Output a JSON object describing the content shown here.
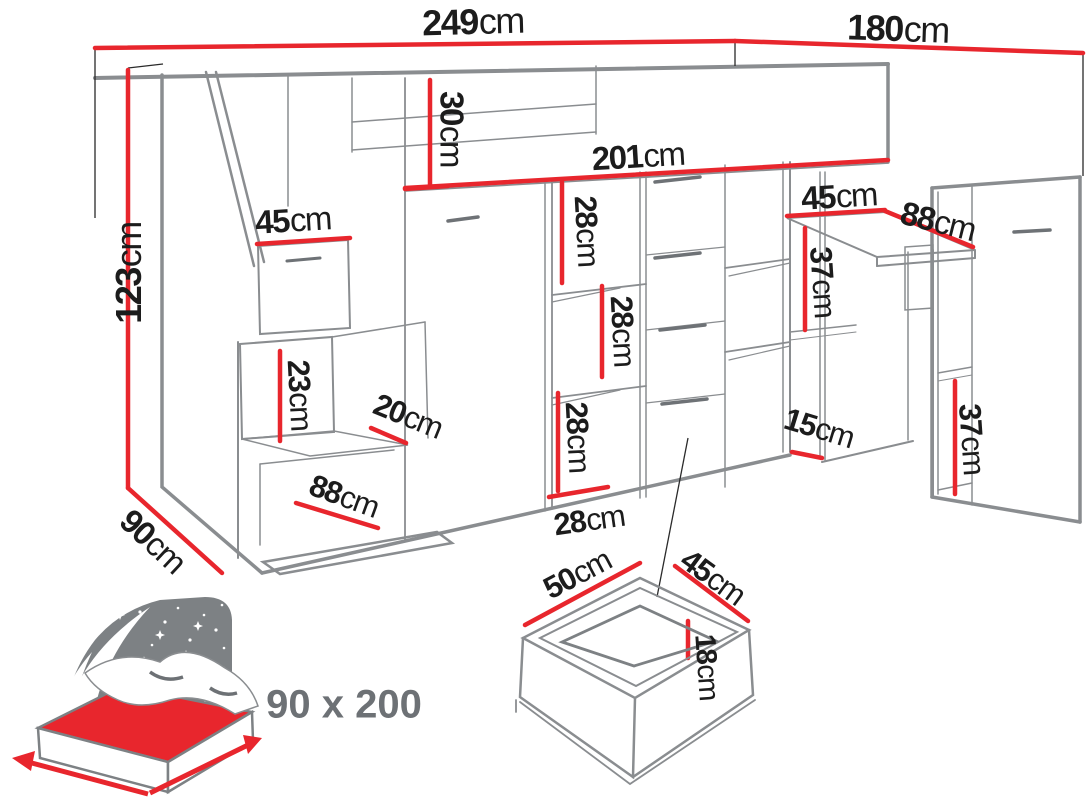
{
  "colors": {
    "dimension_red": "#e8262d",
    "line_gray": "#8a8d90",
    "text_dark": "#1c1c1c",
    "inset_gray": "#7d8184",
    "bed_size_text": "#6d7175"
  },
  "diagram": {
    "dimensions": [
      {
        "name": "total-width",
        "value": "249",
        "unit": "cm"
      },
      {
        "name": "side-depth",
        "value": "180",
        "unit": "cm"
      },
      {
        "name": "height",
        "value": "123",
        "unit": "cm"
      },
      {
        "name": "platform-thickness",
        "value": "30",
        "unit": "cm"
      },
      {
        "name": "cabinets-width",
        "value": "201",
        "unit": "cm"
      },
      {
        "name": "stairs-top-depth",
        "value": "45",
        "unit": "cm"
      },
      {
        "name": "shelf-gap-top",
        "value": "28",
        "unit": "cm"
      },
      {
        "name": "shelf-gap-middle",
        "value": "28",
        "unit": "cm"
      },
      {
        "name": "shelf-gap-bottom",
        "value": "28",
        "unit": "cm"
      },
      {
        "name": "step-height",
        "value": "23",
        "unit": "cm"
      },
      {
        "name": "step-depth",
        "value": "20",
        "unit": "cm"
      },
      {
        "name": "bottom-step-width",
        "value": "88",
        "unit": "cm"
      },
      {
        "name": "shelf-depth",
        "value": "28",
        "unit": "cm"
      },
      {
        "name": "desk-depth",
        "value": "45",
        "unit": "cm"
      },
      {
        "name": "desk-length",
        "value": "88",
        "unit": "cm"
      },
      {
        "name": "under-desk-height",
        "value": "37",
        "unit": "cm"
      },
      {
        "name": "niche-width",
        "value": "15",
        "unit": "cm"
      },
      {
        "name": "bookcase-gap-height",
        "value": "37",
        "unit": "cm"
      },
      {
        "name": "drawer-width",
        "value": "50",
        "unit": "cm"
      },
      {
        "name": "drawer-depth",
        "value": "45",
        "unit": "cm"
      },
      {
        "name": "drawer-height",
        "value": "18",
        "unit": "cm"
      },
      {
        "name": "base-depth",
        "value": "90",
        "unit": "cm"
      }
    ],
    "bed_inset": {
      "size_label": "90 x 200"
    }
  }
}
